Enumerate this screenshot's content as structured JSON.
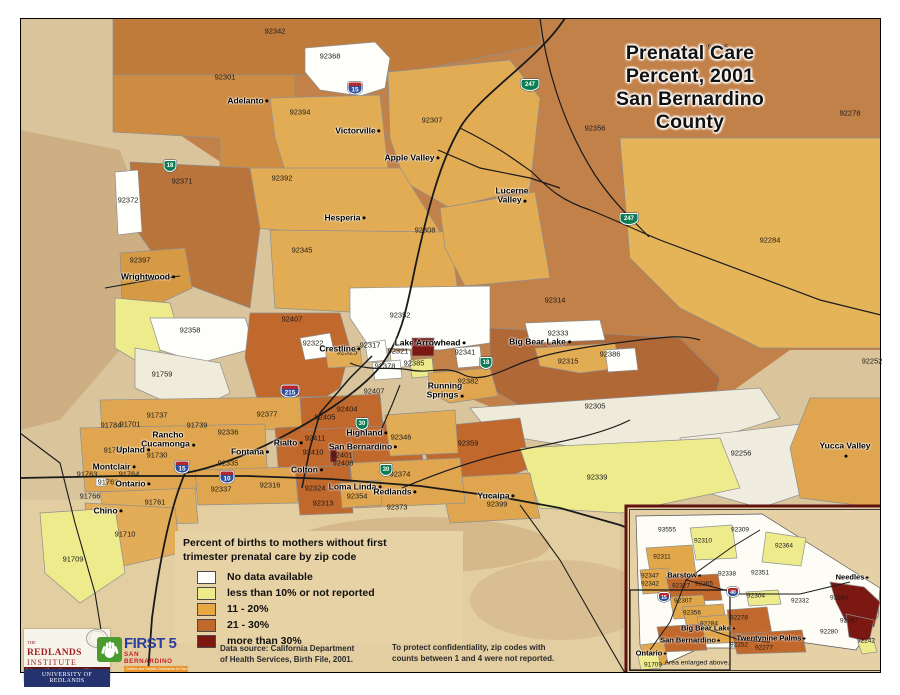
{
  "palette_note": "legend colors drive the choropleth classes",
  "title": {
    "line1": "Prenatal Care Percent, 2001",
    "line2": "San Bernardino County"
  },
  "legend": {
    "heading": "Percent of births to mothers without first\ntrimester prenatal care by zip code",
    "items": [
      {
        "label": "No data available",
        "color": "#FEFEFA"
      },
      {
        "label": "less than 10% or not reported",
        "color": "#EDEB8C"
      },
      {
        "label": "11 - 20%",
        "color": "#E7A743"
      },
      {
        "label": "21 - 30%",
        "color": "#C1682C"
      },
      {
        "label": "more than 30%",
        "color": "#7B1812"
      }
    ]
  },
  "notes": {
    "source": "Data source: California Department\nof Health Services, Birth File, 2001.",
    "confidentiality": "To protect confidentiality, zip codes with\ncounts between 1 and 4 were not reported."
  },
  "map": {
    "zip_labels": [
      {
        "code": "92342",
        "x": 275,
        "y": 31
      },
      {
        "code": "92368",
        "x": 330,
        "y": 56
      },
      {
        "code": "92301",
        "x": 225,
        "y": 77
      },
      {
        "code": "92394",
        "x": 300,
        "y": 112
      },
      {
        "code": "92307",
        "x": 432,
        "y": 120
      },
      {
        "code": "92365",
        "x": 718,
        "y": 47
      },
      {
        "code": "92278",
        "x": 850,
        "y": 113
      },
      {
        "code": "92356",
        "x": 595,
        "y": 128
      },
      {
        "code": "92392",
        "x": 282,
        "y": 178
      },
      {
        "code": "92371",
        "x": 182,
        "y": 181
      },
      {
        "code": "92372",
        "x": 128,
        "y": 200
      },
      {
        "code": "92345",
        "x": 302,
        "y": 250
      },
      {
        "code": "92308",
        "x": 425,
        "y": 230
      },
      {
        "code": "92284",
        "x": 770,
        "y": 240
      },
      {
        "code": "92397",
        "x": 140,
        "y": 260
      },
      {
        "code": "92358",
        "x": 190,
        "y": 330
      },
      {
        "code": "91759",
        "x": 162,
        "y": 374
      },
      {
        "code": "92314",
        "x": 555,
        "y": 300
      },
      {
        "code": "92352",
        "x": 400,
        "y": 315
      },
      {
        "code": "92407",
        "x": 292,
        "y": 319
      },
      {
        "code": "92322",
        "x": 313,
        "y": 343
      },
      {
        "code": "92325",
        "x": 347,
        "y": 352
      },
      {
        "code": "92317",
        "x": 370,
        "y": 345
      },
      {
        "code": "92321",
        "x": 398,
        "y": 351
      },
      {
        "code": "92341",
        "x": 465,
        "y": 352
      },
      {
        "code": "92333",
        "x": 558,
        "y": 333
      },
      {
        "code": "92315",
        "x": 568,
        "y": 361
      },
      {
        "code": "92386",
        "x": 610,
        "y": 354
      },
      {
        "code": "92378",
        "x": 385,
        "y": 366
      },
      {
        "code": "92385",
        "x": 414,
        "y": 363
      },
      {
        "code": "92382",
        "x": 468,
        "y": 381
      },
      {
        "code": "92305",
        "x": 595,
        "y": 406
      },
      {
        "code": "92407",
        "x": 374,
        "y": 391
      },
      {
        "code": "92256",
        "x": 741,
        "y": 453
      },
      {
        "code": "92252",
        "x": 872,
        "y": 361
      },
      {
        "code": "92404",
        "x": 347,
        "y": 409
      },
      {
        "code": "92405",
        "x": 325,
        "y": 417
      },
      {
        "code": "92377",
        "x": 267,
        "y": 414
      },
      {
        "code": "92336",
        "x": 228,
        "y": 432
      },
      {
        "code": "91737",
        "x": 157,
        "y": 415
      },
      {
        "code": "91701",
        "x": 130,
        "y": 424
      },
      {
        "code": "91784",
        "x": 111,
        "y": 425
      },
      {
        "code": "91739",
        "x": 197,
        "y": 425
      },
      {
        "code": "92411",
        "x": 315,
        "y": 438
      },
      {
        "code": "92410",
        "x": 313,
        "y": 452
      },
      {
        "code": "92401",
        "x": 342,
        "y": 455
      },
      {
        "code": "92408",
        "x": 343,
        "y": 463
      },
      {
        "code": "92346",
        "x": 401,
        "y": 437
      },
      {
        "code": "92374",
        "x": 400,
        "y": 474
      },
      {
        "code": "92335",
        "x": 228,
        "y": 463
      },
      {
        "code": "91730",
        "x": 157,
        "y": 455
      },
      {
        "code": "91786",
        "x": 114,
        "y": 450
      },
      {
        "code": "91764",
        "x": 129,
        "y": 474
      },
      {
        "code": "91763",
        "x": 87,
        "y": 474
      },
      {
        "code": "91762",
        "x": 108,
        "y": 482
      },
      {
        "code": "91766",
        "x": 90,
        "y": 496
      },
      {
        "code": "91761",
        "x": 155,
        "y": 502
      },
      {
        "code": "92337",
        "x": 221,
        "y": 489
      },
      {
        "code": "92316",
        "x": 270,
        "y": 485
      },
      {
        "code": "92324",
        "x": 315,
        "y": 488
      },
      {
        "code": "92313",
        "x": 323,
        "y": 503
      },
      {
        "code": "92354",
        "x": 357,
        "y": 496
      },
      {
        "code": "92373",
        "x": 397,
        "y": 507
      },
      {
        "code": "91710",
        "x": 125,
        "y": 534
      },
      {
        "code": "91709",
        "x": 73,
        "y": 559
      },
      {
        "code": "92359",
        "x": 468,
        "y": 443
      },
      {
        "code": "92339",
        "x": 597,
        "y": 477
      },
      {
        "code": "92399",
        "x": 497,
        "y": 504
      }
    ],
    "city_labels": [
      {
        "name": "Adelanto",
        "x": 248,
        "y": 101
      },
      {
        "name": "Victorville",
        "x": 358,
        "y": 131
      },
      {
        "name": "Apple Valley",
        "x": 412,
        "y": 158
      },
      {
        "name": "Hesperia",
        "x": 345,
        "y": 218
      },
      {
        "name": "Lucerne\nValley",
        "x": 512,
        "y": 196
      },
      {
        "name": "Wrightwood",
        "x": 148,
        "y": 277
      },
      {
        "name": "Crestline",
        "x": 340,
        "y": 349
      },
      {
        "name": "Lake Arrowhead",
        "x": 430,
        "y": 343
      },
      {
        "name": "Big Bear Lake",
        "x": 540,
        "y": 342
      },
      {
        "name": "Running\nSprings",
        "x": 445,
        "y": 391
      },
      {
        "name": "Highland",
        "x": 367,
        "y": 433
      },
      {
        "name": "San Bernardino",
        "x": 363,
        "y": 447
      },
      {
        "name": "Rialto",
        "x": 288,
        "y": 443
      },
      {
        "name": "Fontana",
        "x": 250,
        "y": 452
      },
      {
        "name": "Colton",
        "x": 307,
        "y": 470
      },
      {
        "name": "Rancho\nCucamonga",
        "x": 168,
        "y": 440
      },
      {
        "name": "Upland",
        "x": 133,
        "y": 450
      },
      {
        "name": "Montclair",
        "x": 114,
        "y": 467
      },
      {
        "name": "Ontario",
        "x": 133,
        "y": 484
      },
      {
        "name": "Chino",
        "x": 108,
        "y": 511
      },
      {
        "name": "Loma Linda",
        "x": 355,
        "y": 487
      },
      {
        "name": "Redlands",
        "x": 395,
        "y": 492
      },
      {
        "name": "Yucaipa",
        "x": 496,
        "y": 496
      },
      {
        "name": "Yucca Valley",
        "x": 845,
        "y": 451
      }
    ],
    "shields": [
      {
        "label": "15",
        "x": 355,
        "y": 88,
        "cls": "interstate"
      },
      {
        "label": "215",
        "x": 290,
        "y": 391,
        "cls": "interstate wide"
      },
      {
        "label": "15",
        "x": 182,
        "y": 467,
        "cls": "interstate"
      },
      {
        "label": "10",
        "x": 227,
        "y": 477,
        "cls": "interstate"
      },
      {
        "label": "18",
        "x": 170,
        "y": 166,
        "cls": "state"
      },
      {
        "label": "247",
        "x": 530,
        "y": 85,
        "cls": "state wide"
      },
      {
        "label": "247",
        "x": 629,
        "y": 219,
        "cls": "state wide"
      },
      {
        "label": "18",
        "x": 486,
        "y": 363,
        "cls": "state"
      },
      {
        "label": "30",
        "x": 362,
        "y": 424,
        "cls": "state"
      },
      {
        "label": "30",
        "x": 386,
        "y": 470,
        "cls": "state"
      }
    ]
  },
  "inset": {
    "caption": "Area enlarged above.",
    "zip_labels": [
      {
        "code": "93555",
        "x": 667,
        "y": 530
      },
      {
        "code": "92310",
        "x": 703,
        "y": 541
      },
      {
        "code": "92309",
        "x": 740,
        "y": 530
      },
      {
        "code": "92364",
        "x": 784,
        "y": 546
      },
      {
        "code": "92311",
        "x": 662,
        "y": 557
      },
      {
        "code": "92347",
        "x": 650,
        "y": 576
      },
      {
        "code": "92342",
        "x": 650,
        "y": 584
      },
      {
        "code": "92327",
        "x": 681,
        "y": 586
      },
      {
        "code": "92365",
        "x": 704,
        "y": 584
      },
      {
        "code": "92338",
        "x": 727,
        "y": 574
      },
      {
        "code": "92351",
        "x": 760,
        "y": 573
      },
      {
        "code": "92304",
        "x": 756,
        "y": 596
      },
      {
        "code": "92307",
        "x": 683,
        "y": 601
      },
      {
        "code": "92356",
        "x": 692,
        "y": 613
      },
      {
        "code": "92284",
        "x": 709,
        "y": 624
      },
      {
        "code": "92278",
        "x": 739,
        "y": 618
      },
      {
        "code": "92332",
        "x": 800,
        "y": 601
      },
      {
        "code": "92363",
        "x": 839,
        "y": 598
      },
      {
        "code": "92267",
        "x": 849,
        "y": 621
      },
      {
        "code": "92280",
        "x": 829,
        "y": 632
      },
      {
        "code": "92242",
        "x": 866,
        "y": 641
      },
      {
        "code": "92252",
        "x": 739,
        "y": 645
      },
      {
        "code": "92277",
        "x": 764,
        "y": 648
      },
      {
        "code": "91709",
        "x": 653,
        "y": 665
      }
    ],
    "city_labels": [
      {
        "name": "Barstow",
        "x": 684,
        "y": 575
      },
      {
        "name": "Needles",
        "x": 852,
        "y": 577
      },
      {
        "name": "Big Bear Lake",
        "x": 708,
        "y": 628
      },
      {
        "name": "Twentynine Palms",
        "x": 771,
        "y": 638
      },
      {
        "name": "San Bernardino",
        "x": 690,
        "y": 640
      },
      {
        "name": "Ontario",
        "x": 651,
        "y": 653
      }
    ],
    "shields": [
      {
        "label": "15",
        "x": 664,
        "y": 597,
        "cls": "interstate small"
      },
      {
        "label": "40",
        "x": 733,
        "y": 592,
        "cls": "interstate small"
      }
    ]
  },
  "logos": {
    "redlands": {
      "the": "THE",
      "name": "REDLANDS",
      "institute": "INSTITUTE",
      "bar": "Environmental Design, Management, and Policy",
      "university": "UNIVERSITY OF REDLANDS"
    },
    "first5": {
      "name": "FIRST 5",
      "region": "SAN BERNARDINO",
      "tagline": "Children and Families Commission for San Bernardino County"
    }
  }
}
